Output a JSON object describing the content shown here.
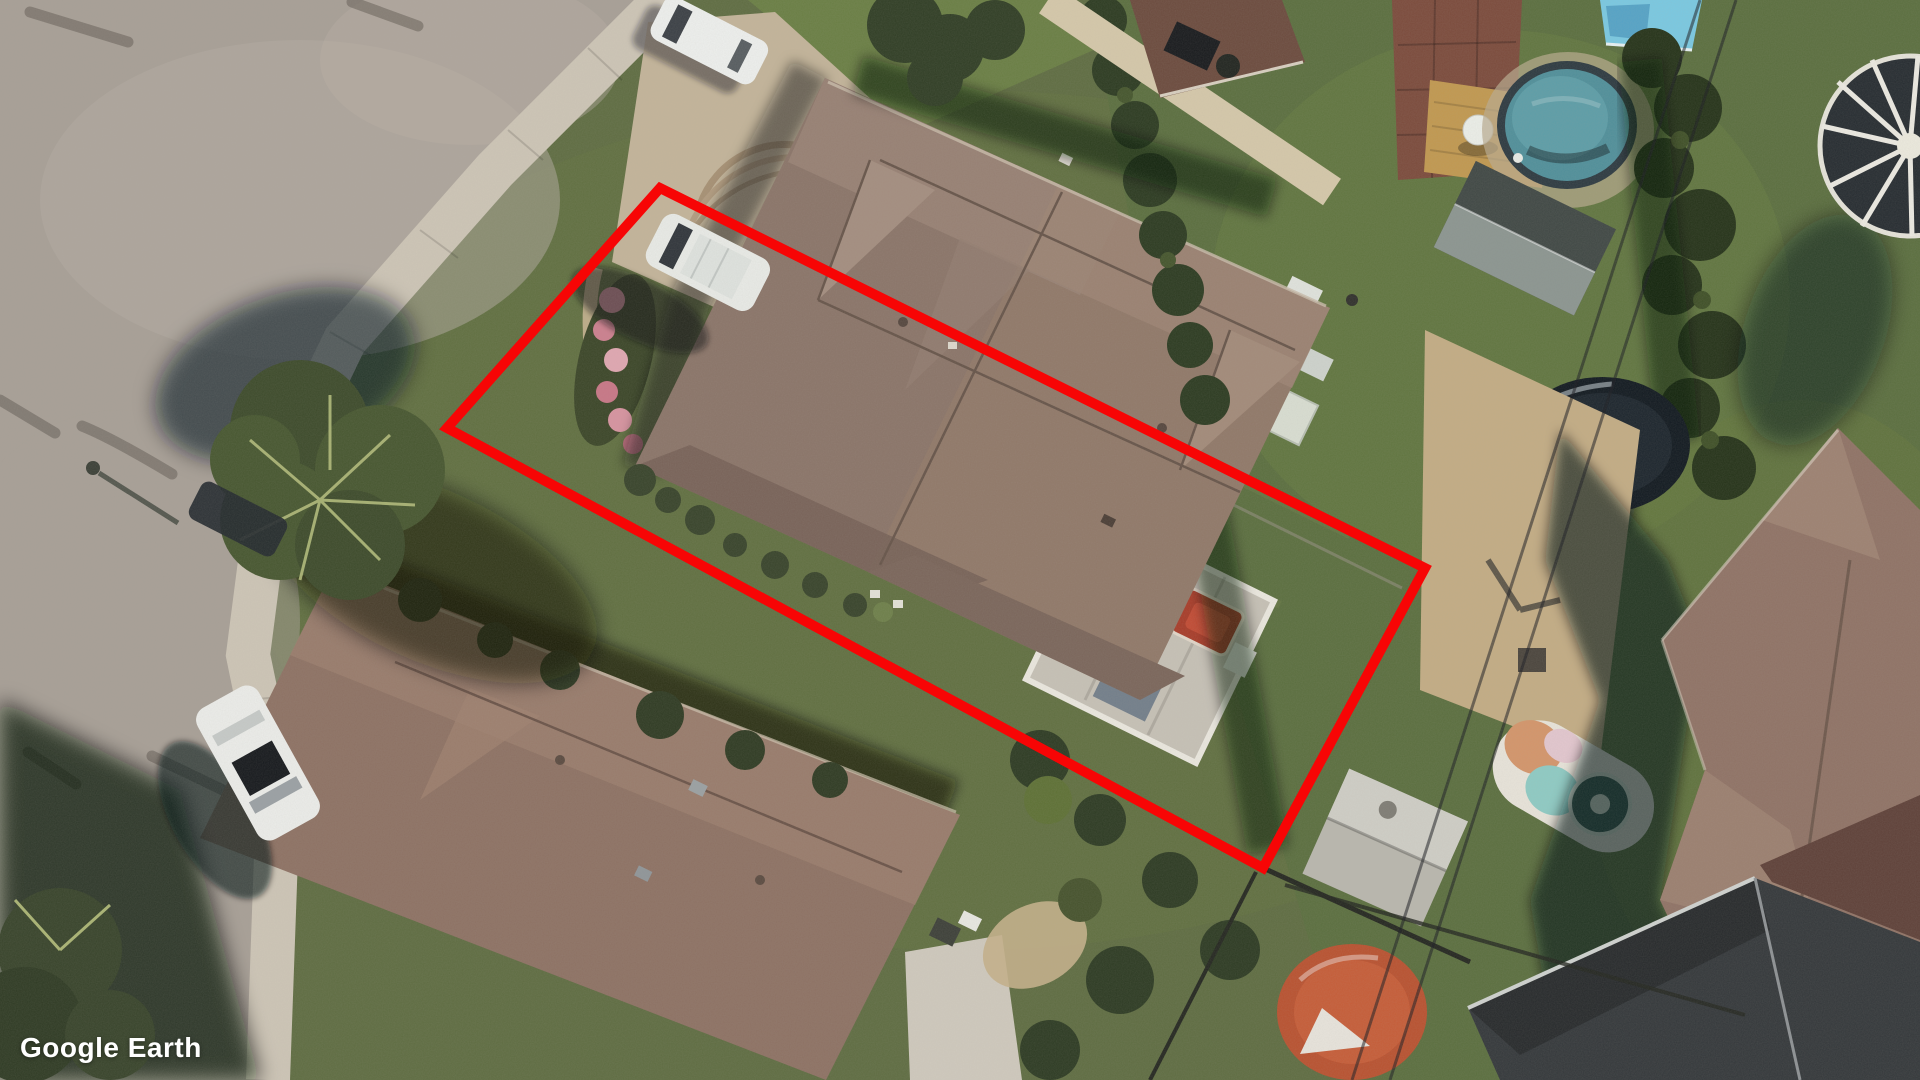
{
  "meta": {
    "application": "Google Earth",
    "view_type": "aerial satellite imagery, suburban residential neighborhood"
  },
  "watermark": {
    "text": "Google Earth",
    "color": "#ffffff"
  },
  "highlight": {
    "label": "red property-boundary outline around the center lot",
    "points": "660,188 1425,568 1263,868 447,428",
    "stroke": "#f70505",
    "stroke_width": "10"
  },
  "palette": {
    "road": "#a79f96",
    "sidewalk": "#cdc5b6",
    "driveway": "#c3b499",
    "lawn": "#5e6c41",
    "main_roof": "#8a7468",
    "neighbor_roof": "#8d7163",
    "right_house_roof": "#8f7265",
    "pool_water": "#4f8f9a",
    "small_pool_water": "#79c9e2",
    "deck_wood": "#c1984f",
    "brick_patio": "#7b4a3b",
    "dark_building_roof": "#33373a",
    "kiddie_pool": "#b9512f",
    "shadow": "#0b0e12"
  },
  "scene": {
    "objects": [
      "highlighted residential parcel with long brown-roof duplex house",
      "white van parked on driveway inside outline",
      "white car parked on street at top",
      "white car with sunroof parked at lower-left curb",
      "dark car under street tree",
      "large street tree with shadow",
      "back patio with red hot tub, grill and furniture",
      "neighbor house lower-left with brown roof and skylights",
      "right lot: oval above-ground pool, wooden deck, brick patio",
      "right lot: dark shed, tall hedges, trampoline, beach towel, gazebo",
      "right house with pink-brown hip roof and long shadow",
      "bottom-right dark flat roof and terracotta kiddie pool, gray shed",
      "overhead utility wires",
      "Google Earth watermark"
    ]
  }
}
